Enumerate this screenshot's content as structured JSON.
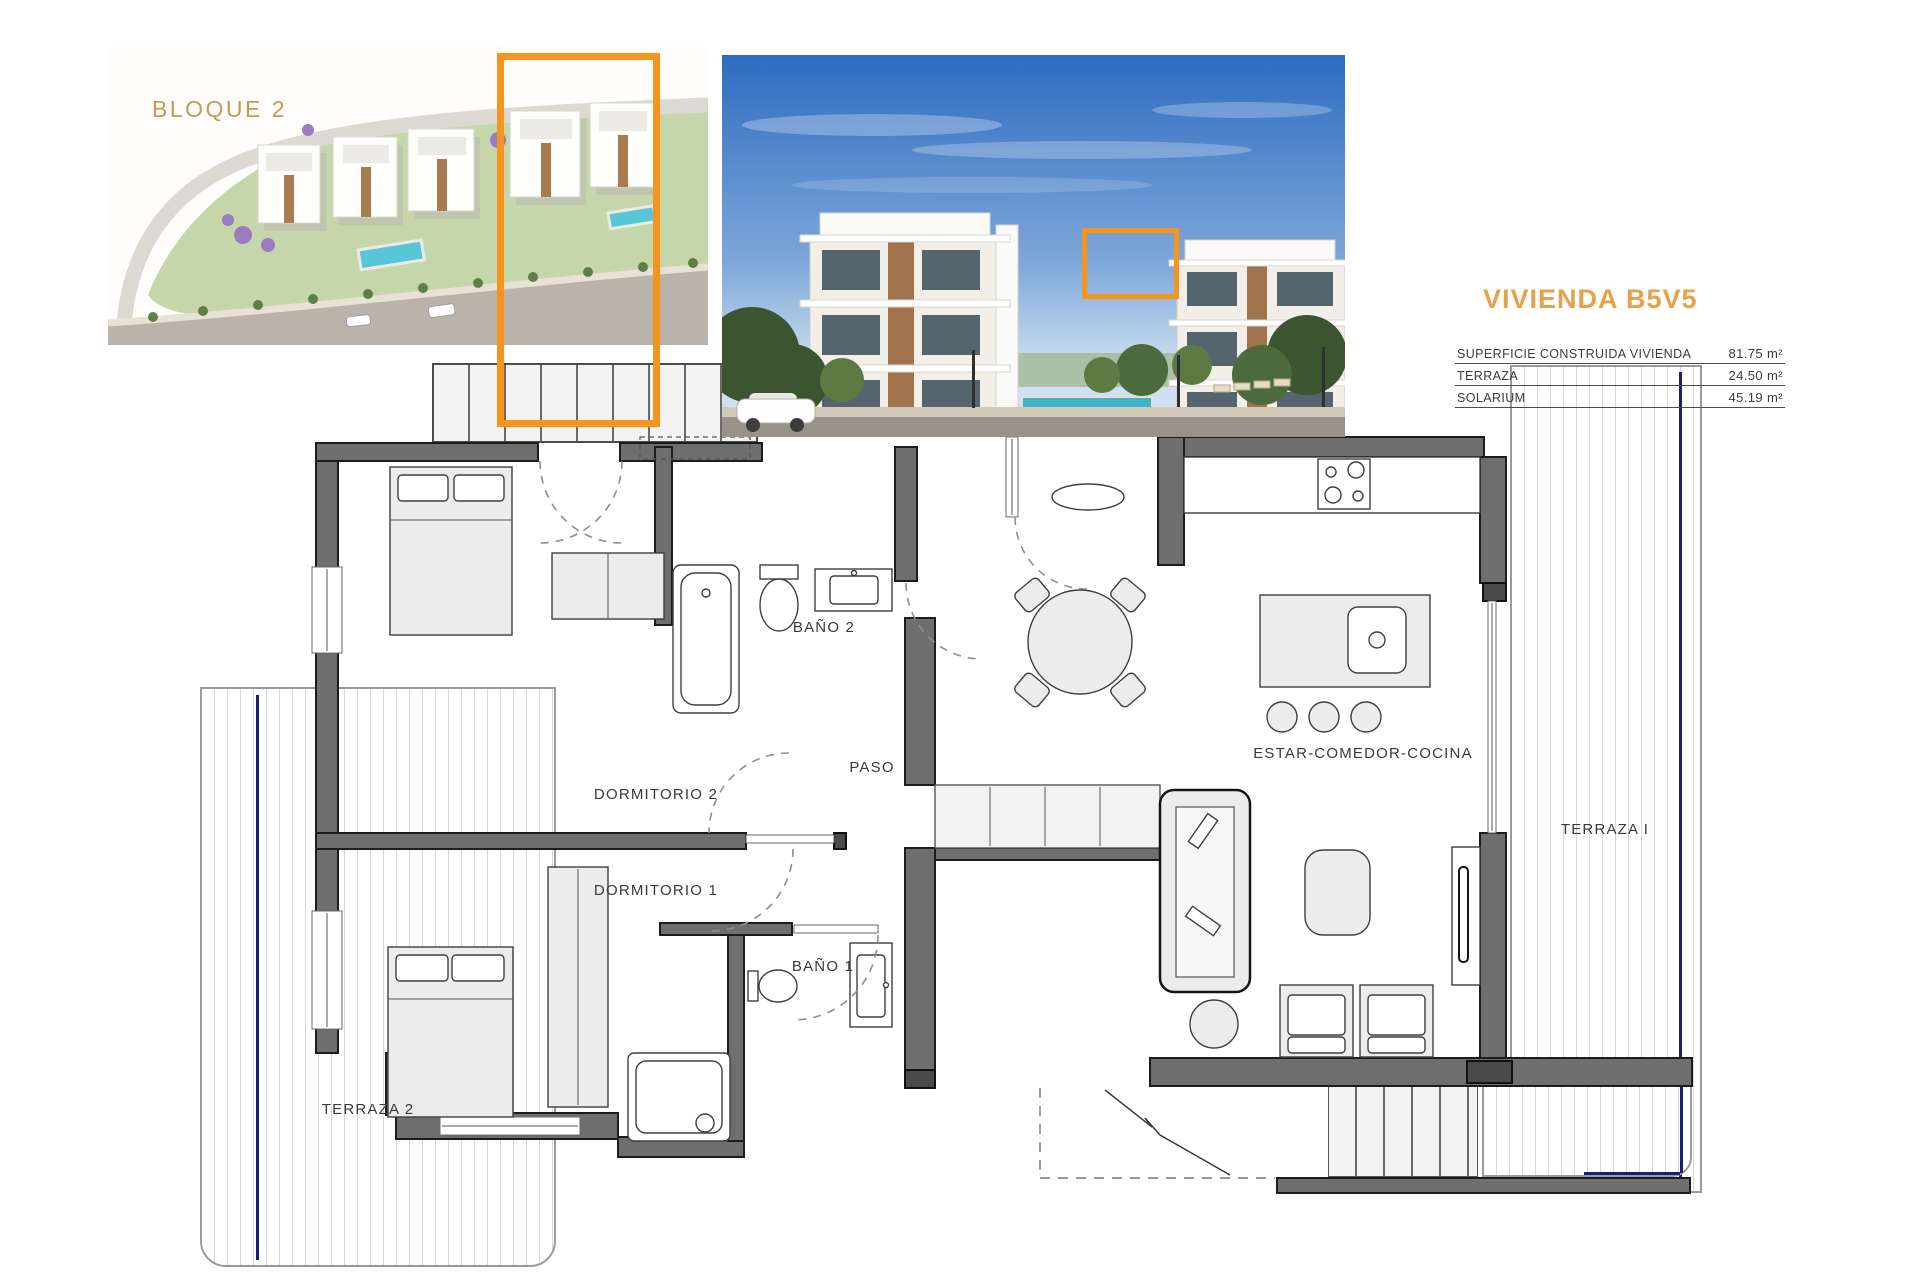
{
  "header": {
    "bloque_label": "BLOQUE 2",
    "unit_title": "VIVIENDA B5V5"
  },
  "areas_table": {
    "rows": [
      {
        "label": "SUPERFICIE CONSTRUIDA VIVIENDA",
        "value": "81.75 m²"
      },
      {
        "label": "TERRAZA",
        "value": "24.50 m²"
      },
      {
        "label": "SOLARIUM",
        "value": "45.19 m²"
      }
    ]
  },
  "plan": {
    "rooms": {
      "dormitorio2": "DORMITORIO 2",
      "dormitorio1": "DORMITORIO 1",
      "bano2": "BAÑO 2",
      "bano1": "BAÑO 1",
      "paso": "PASO",
      "estar": "ESTAR-COMEDOR-COCINA",
      "terraza1": "TERRAZA I",
      "terraza2": "TERRAZA 2"
    }
  },
  "colors": {
    "highlight_orange": "#F7941D",
    "title_orange": "#E8A14B",
    "bloque_tan": "#C79A52",
    "wall_gray": "#6E6E6E",
    "terrace_navy": "#1A1F71"
  }
}
